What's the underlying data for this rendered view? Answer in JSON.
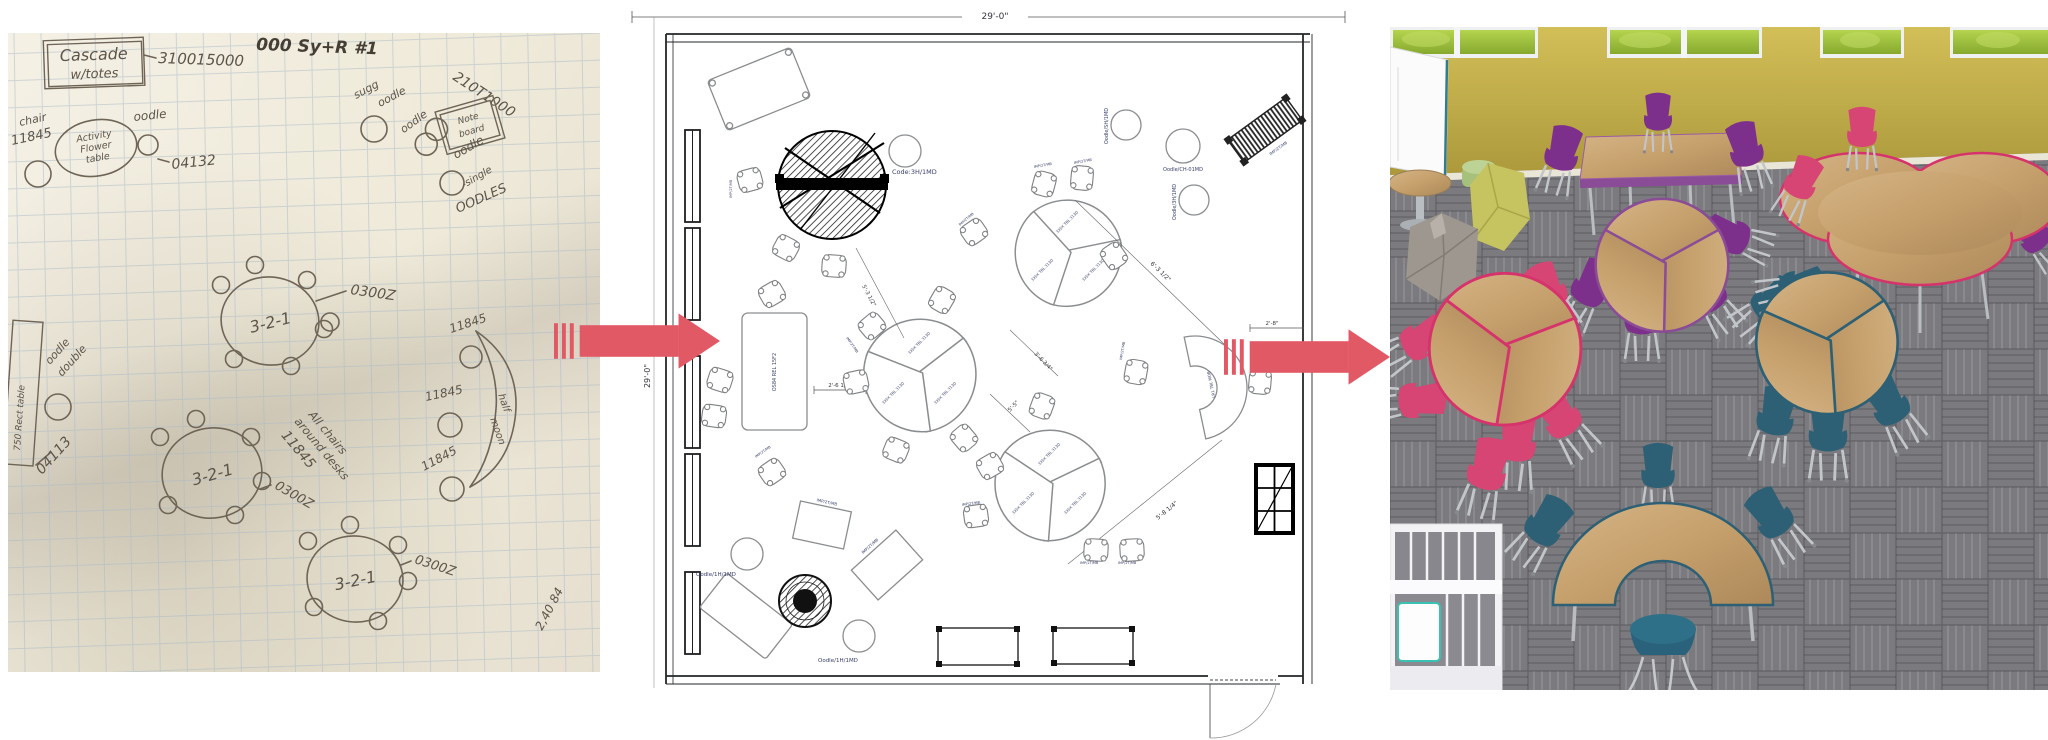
{
  "page": {
    "background": "#ffffff"
  },
  "arrow": {
    "color": "#e25966"
  },
  "sketch": {
    "box_title_line1": "Cascade",
    "box_title_line2": "w/totes",
    "code_top": "310015000",
    "heading": "000 Sy+R #1",
    "code_210": "210T1000",
    "note_board_line1": "Note",
    "note_board_line2": "board",
    "sugg": "sugg",
    "oodle": "oodle",
    "oodle_single": "-single",
    "oodles": "OODLES",
    "chair_word": "chair",
    "chair_code": "11845",
    "flower_line1": "Activity",
    "flower_line2": "Flower",
    "flower_line3": "table",
    "code_04132": "04132",
    "table_label": "3-2-1",
    "code_0300z": "0300Z",
    "all_chairs_line1": "All chairs",
    "all_chairs_line2": "around desks",
    "oodle_double_line1": "oodle",
    "oodle_double_line2": "double",
    "code_04113": "04113",
    "rect_table_note": "750 Rect table",
    "half_moon_line1": "half",
    "half_moon_line2": "moon",
    "corner_note": "2,40 84"
  },
  "plan": {
    "dim_width": "29'-0\"",
    "dim_height": "29'-0\"",
    "dims": {
      "d1": "5'-3 1/2\"",
      "d2": "2'-6 1/8\"",
      "d3": "3'-6 3/4\"",
      "d4": "5'-5\"",
      "d5": "6'-3 1/2\"",
      "d6": "2'-8\"",
      "d7": "5'-8 1/4\""
    },
    "labels": {
      "code_3h1md": "Code:3H/1MD",
      "oodle_1h1md": "Oodle/1H/1MD",
      "oodle_sh1md": "Oodle/SH/1MD",
      "oodle_ch01md": "Oodle/CH-01MD",
      "oodle_3h1md": "Oodle/3H/1MD",
      "chair_tag": "IMP/2T/MB",
      "rect_table_tag": "OS84 REL 15F2",
      "lobe_tag": "3X5X TBL 313D",
      "crescent_tag": "LR1 TBL MOB"
    }
  },
  "render": {
    "palette": {
      "wall": "#c4b148",
      "carpet": "#7b7a7e",
      "wood": "#c5a06c",
      "chair_purple": "#7d2f8c",
      "chair_pink": "#d64573",
      "chair_blue": "#2e6075",
      "trim_pink": "#d6336c",
      "trim_purple": "#8a4b97",
      "trim_blue": "#2e6075",
      "greenery": "#9abd3a",
      "lounge_chartreuse": "#c6c361",
      "lounge_gray": "#9e978f",
      "ottoman_green": "#a6c17c",
      "shelving_white": "#f3f3f5",
      "machine_teal": "#38c2b4"
    }
  }
}
